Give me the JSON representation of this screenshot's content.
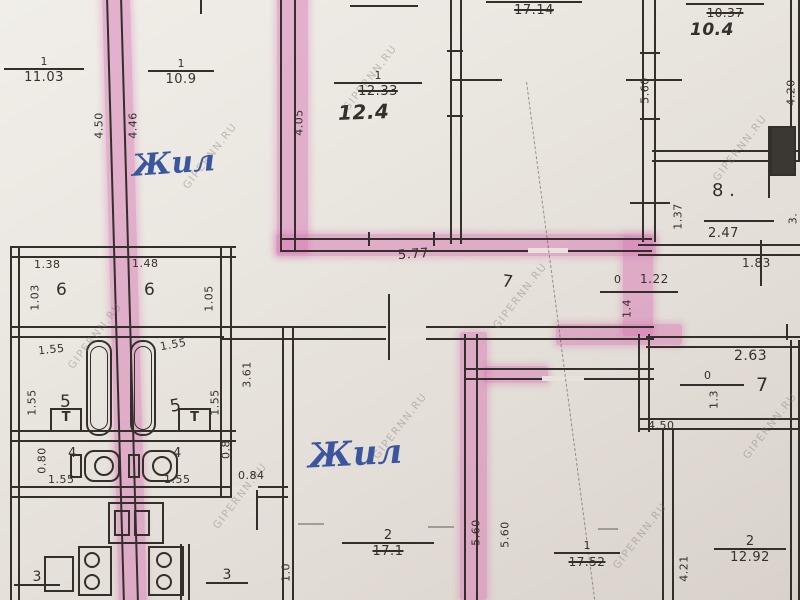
{
  "plan": {
    "watermark": "GIPERNN.RU",
    "notes": {
      "zhil_top": "Жил",
      "zhil_bottom": "Жил"
    },
    "handwritten": {
      "area_12_4": "12.4",
      "area_10_4": "10.4"
    },
    "rooms": {
      "six_a": "6",
      "six_b": "6",
      "five_a": "5",
      "five_b": "5",
      "four_a": "4",
      "four_b": "4",
      "seven_hall": "7",
      "seven_right": "7",
      "eight": "8 .",
      "zero_a": "0",
      "zero_b": "0"
    },
    "fractions": {
      "f1103": {
        "num": "1",
        "area": "11.03"
      },
      "f109": {
        "num": "1",
        "area": "10.9"
      },
      "f1233": {
        "num": "1",
        "area": "12.33"
      },
      "f1714": {
        "area": "17.14"
      },
      "f1037": {
        "area": "10.37"
      },
      "f171": {
        "num": "2",
        "area": "17.1"
      },
      "f1752": {
        "num": "1",
        "area": "17.52"
      },
      "f1292": {
        "num": "2",
        "area": "12.92"
      },
      "f3l": {
        "num": "3"
      },
      "f3r": {
        "num": "3"
      }
    },
    "dims": {
      "v450": "4.50",
      "v446": "4.46",
      "v405": "4.05",
      "v560_top": "5.60",
      "v420": "4.20",
      "h577": "5.77",
      "v137": "1.37",
      "h247": "2.47",
      "h183": "1.83",
      "h122": "1.22",
      "v14": "1.4",
      "v13": "1.3",
      "h263": "2.63",
      "h450": "4.50",
      "v421": "4.21",
      "v560_l": "5.60",
      "v560_r": "5.60",
      "h138": "1.38",
      "h148": "1.48",
      "v103": "1.03",
      "v105": "1.05",
      "h155_a": "1.55",
      "h155_b": "1.55",
      "v155_a": "1.55",
      "v155_b": "1.55",
      "v361": "3.61",
      "h155_c": "1.55",
      "h155_d": "1.55",
      "v080": "0.80",
      "v08": "0.8",
      "h084": "0.84",
      "v10": "1.0",
      "v3cut": "3."
    },
    "symbols": {
      "sink": "T"
    },
    "colors": {
      "highlight": "#d776b4",
      "ink": "#33302c",
      "pen": "#3b55a0",
      "paper": "#e9e5df"
    }
  }
}
